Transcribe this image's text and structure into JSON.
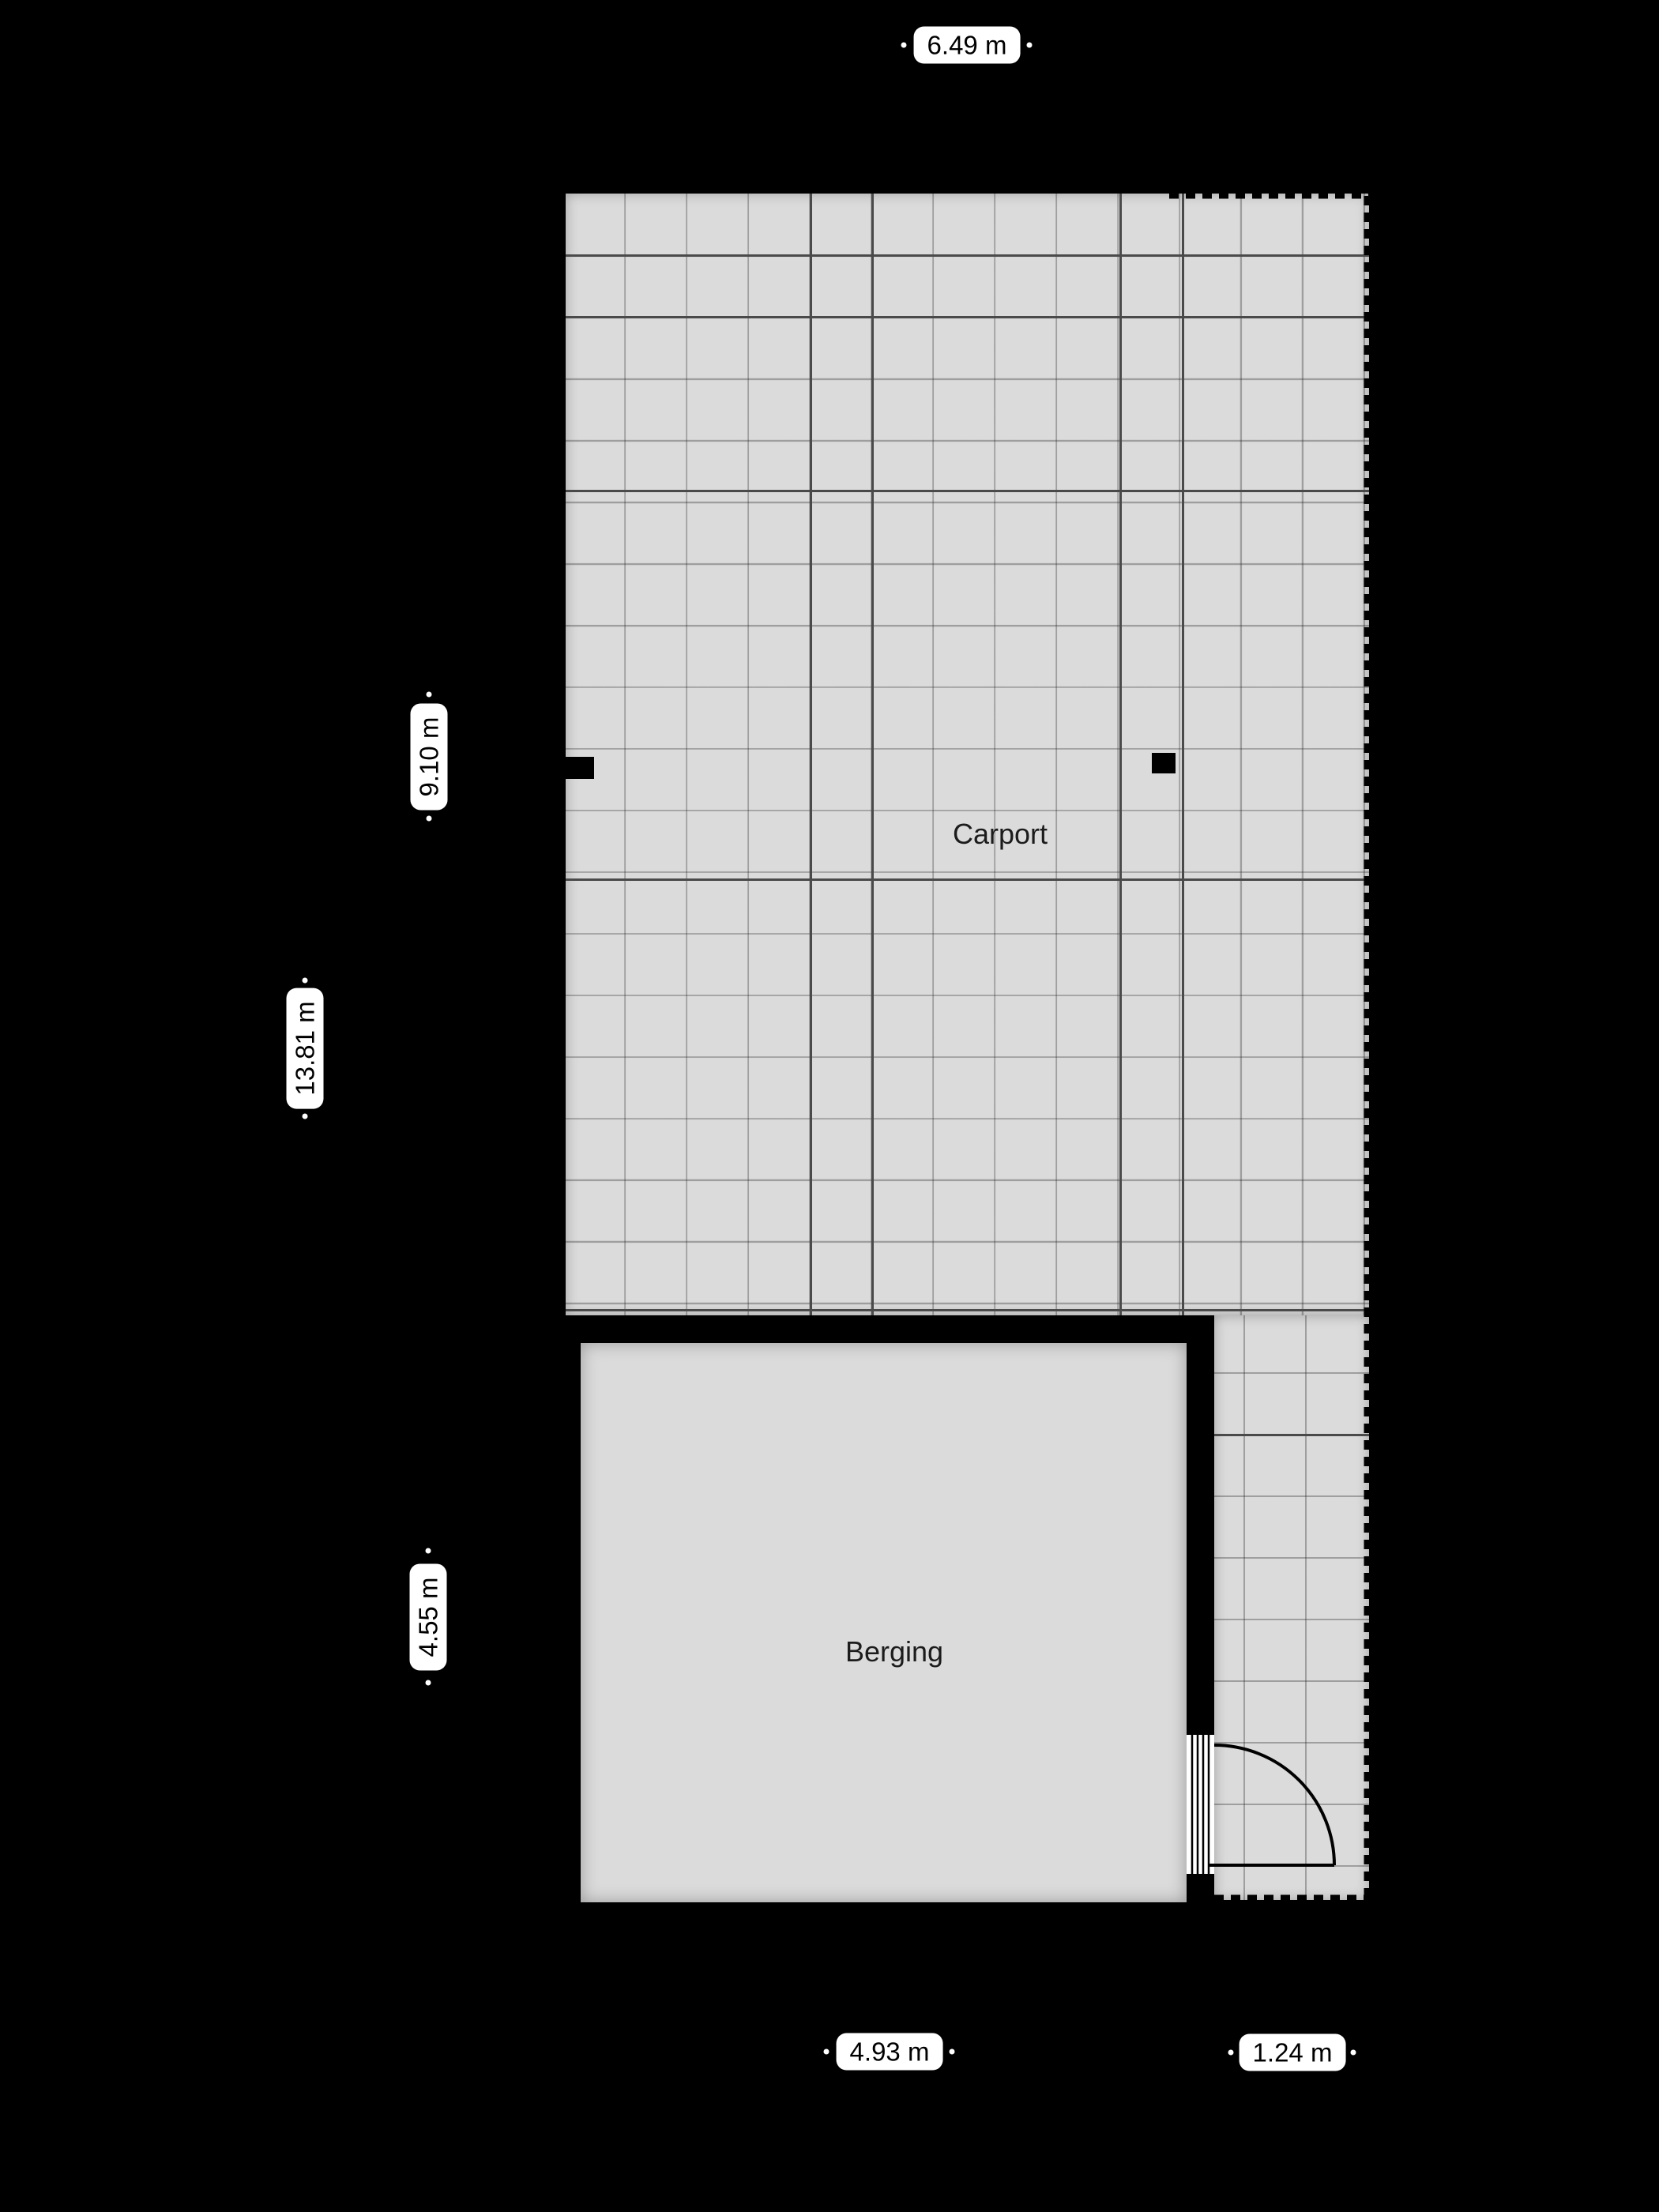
{
  "rooms": {
    "carport": {
      "label": "Carport"
    },
    "berging": {
      "label": "Berging"
    }
  },
  "dimensions": {
    "overall_width": "6.49 m",
    "carport_depth": "9.10 m",
    "overall_depth": "13.81 m",
    "berging_depth": "4.55 m",
    "berging_width": "4.93 m",
    "side_strip_width": "1.24 m"
  },
  "colors": {
    "background": "#000000",
    "floor": "#dbdbdb",
    "grid_line_dark": "#4a4a4a",
    "wall": "#000000",
    "label_background": "#ffffff",
    "label_text": "#000000",
    "room_text": "#1c1c1c"
  }
}
